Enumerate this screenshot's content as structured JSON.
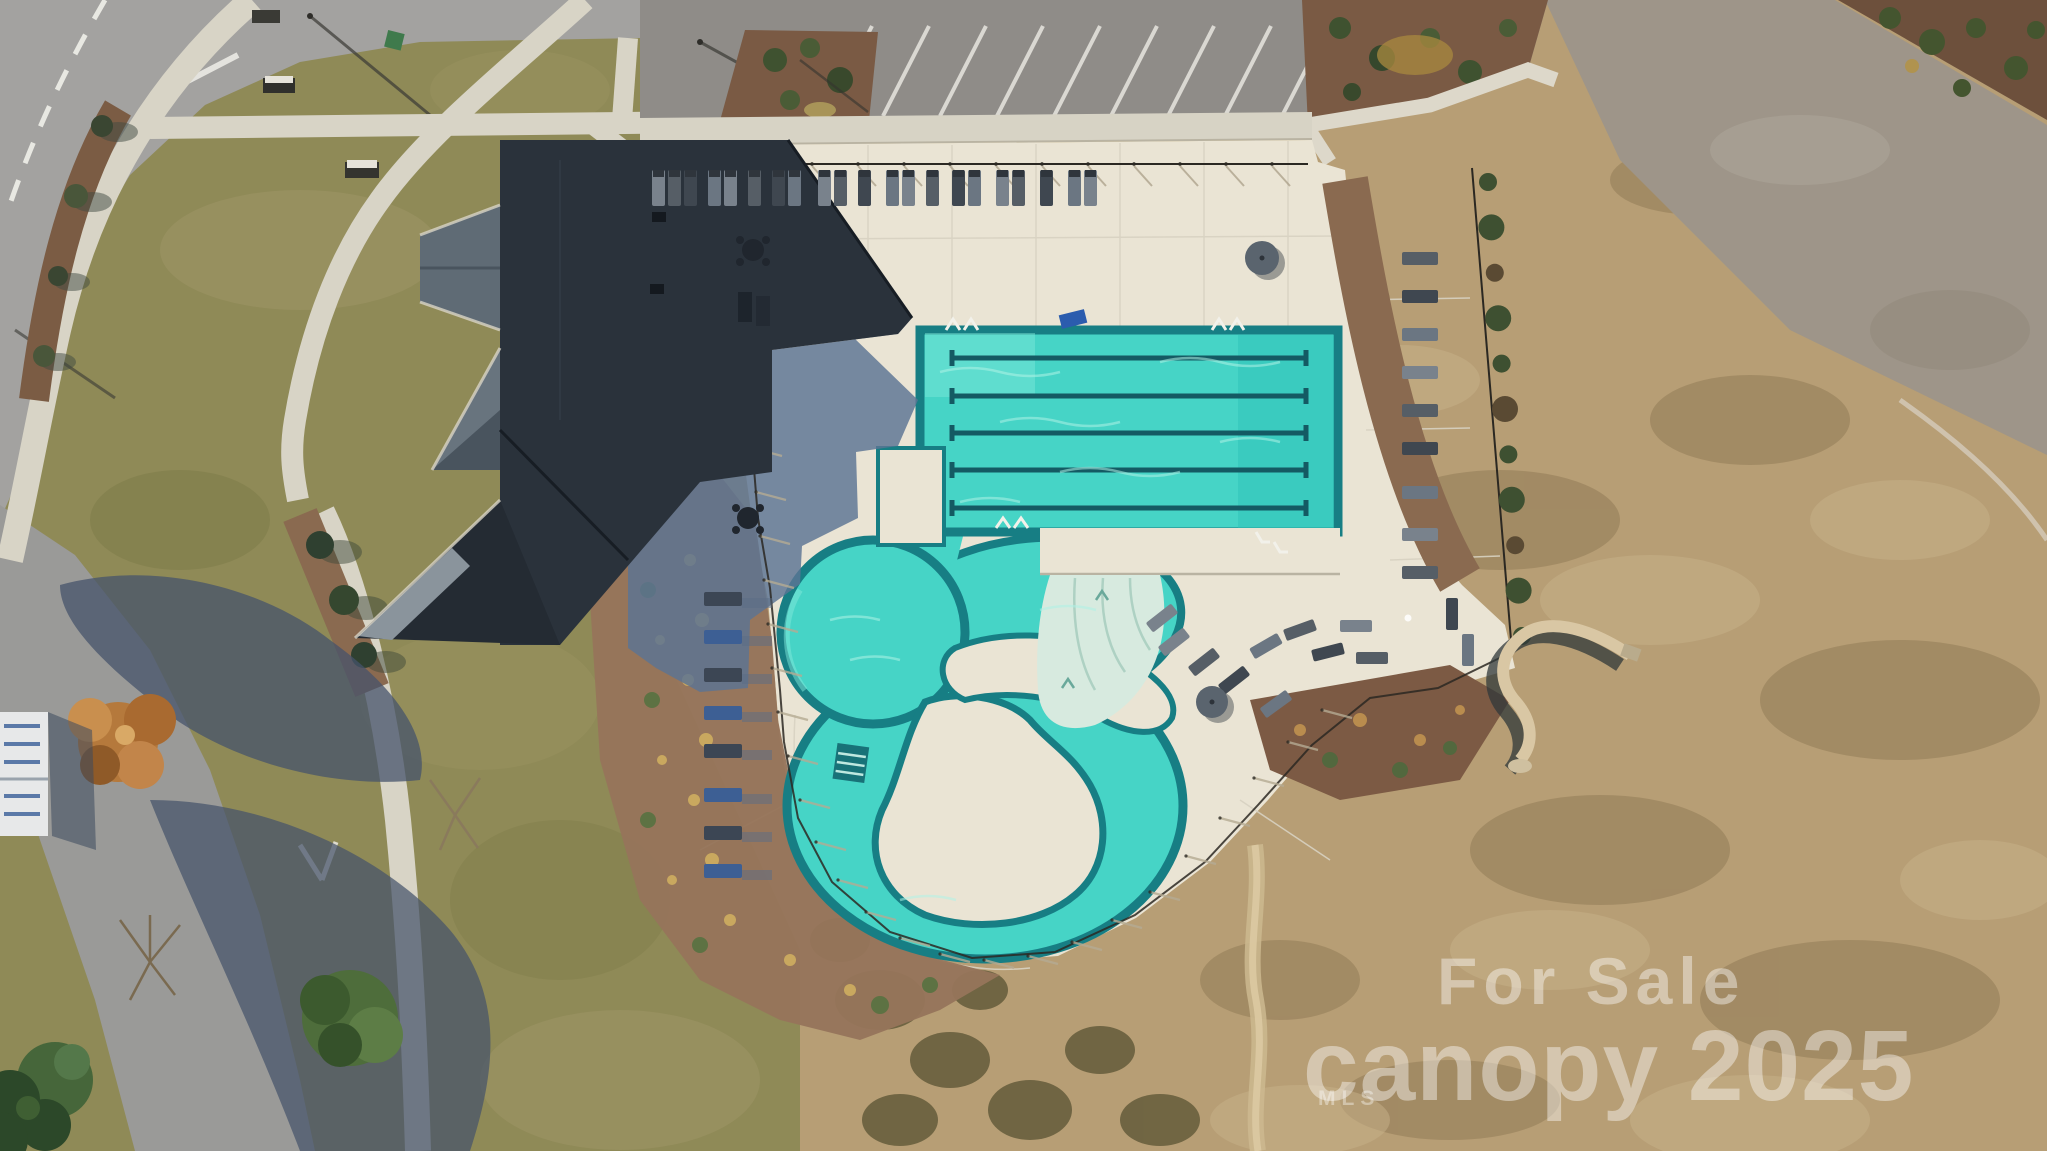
{
  "watermark": {
    "line1": "For Sale",
    "brand": "canopy",
    "year": "2025",
    "sub": "MLS",
    "color": "rgba(255,255,255,0.42)"
  },
  "scene": {
    "description": "Aerial drone photo of a community amenity center: clubhouse with dark roof, rectangular lap pool with five lane lines, free-form lazy-river pool with islands and beach entry, sun deck with lounge chairs and umbrellas, parking lot with angled stalls, curving streets with sidewalks, landscaping and a bare field with a water slide.",
    "labels": {
      "clubhouse": "clubhouse-roof",
      "lap_pool": "lap-pool",
      "leisure_pool": "lazy-river-pool",
      "beach_entry": "beach-entry",
      "deck": "pool-deck",
      "parking": "parking-lot",
      "field": "bare-field",
      "slide": "water-slide"
    }
  },
  "palette": {
    "water": "#46d4c6",
    "water_deep_edge": "#177e84",
    "deck": "#eae4d4",
    "grass": "#8f8a57",
    "field": "#b79e75",
    "mulch": "#96755b",
    "roof_dark": "#2a323b",
    "roof_light": "#5f6b75",
    "shadow_blue": "#5b7494",
    "road": "#a3a2a0",
    "stripe_white": "#eceae4"
  },
  "builders": {
    "parking_stripes": {
      "x_start": 872,
      "y_top": 26,
      "y_bot": 116,
      "dx": -46,
      "spacing": 57,
      "count": 9,
      "color": "#e8e6e0"
    },
    "top_fence": {
      "x0": 628,
      "x1": 1308,
      "y": 164,
      "post_step": 46
    },
    "lounger_rows": {
      "top_row": {
        "y": 170,
        "w": 13,
        "h": 36,
        "xs": [
          652,
          668,
          684,
          708,
          724,
          748,
          772,
          788,
          818,
          834,
          858,
          886,
          902,
          926,
          952,
          968,
          996,
          1012,
          1040,
          1068,
          1084
        ]
      },
      "right_col": {
        "x": 1402,
        "w": 36,
        "h": 13,
        "ys": [
          252,
          290,
          328,
          366,
          404,
          442,
          486,
          528,
          566
        ]
      },
      "west_col": {
        "x": 704,
        "w": 38,
        "h": 14,
        "ys": [
          592,
          630,
          668,
          706,
          744,
          788,
          826,
          864
        ]
      }
    },
    "cluster_br": [
      [
        1158,
        636,
        -38
      ],
      [
        1188,
        656,
        -38
      ],
      [
        1218,
        674,
        -38
      ],
      [
        1250,
        640,
        -30
      ],
      [
        1146,
        612,
        -38
      ],
      [
        1284,
        624,
        -20
      ],
      [
        1312,
        646,
        -14
      ],
      [
        1260,
        698,
        -36
      ],
      [
        1340,
        620,
        0
      ],
      [
        1356,
        652,
        0
      ],
      [
        1436,
        608,
        90
      ],
      [
        1452,
        644,
        90
      ]
    ],
    "umbrellas": [
      [
        1262,
        258,
        17
      ],
      [
        1212,
        702,
        16
      ]
    ],
    "east_hedge": {
      "x0": 1488,
      "y0": 182,
      "x1": 1522,
      "y1": 636,
      "count": 11
    },
    "fence_ticks": [
      [
        752,
        448
      ],
      [
        756,
        492
      ],
      [
        760,
        536
      ],
      [
        764,
        580
      ],
      [
        768,
        624
      ],
      [
        772,
        668
      ],
      [
        778,
        712
      ],
      [
        788,
        756
      ],
      [
        800,
        800
      ],
      [
        816,
        842
      ],
      [
        838,
        880
      ],
      [
        866,
        912
      ],
      [
        900,
        938
      ],
      [
        940,
        954
      ],
      [
        984,
        960
      ],
      [
        1028,
        956
      ],
      [
        1072,
        942
      ],
      [
        1112,
        920
      ],
      [
        1150,
        892
      ],
      [
        1186,
        856
      ],
      [
        1220,
        818
      ],
      [
        1254,
        778
      ],
      [
        1288,
        742
      ],
      [
        1322,
        710
      ]
    ]
  }
}
